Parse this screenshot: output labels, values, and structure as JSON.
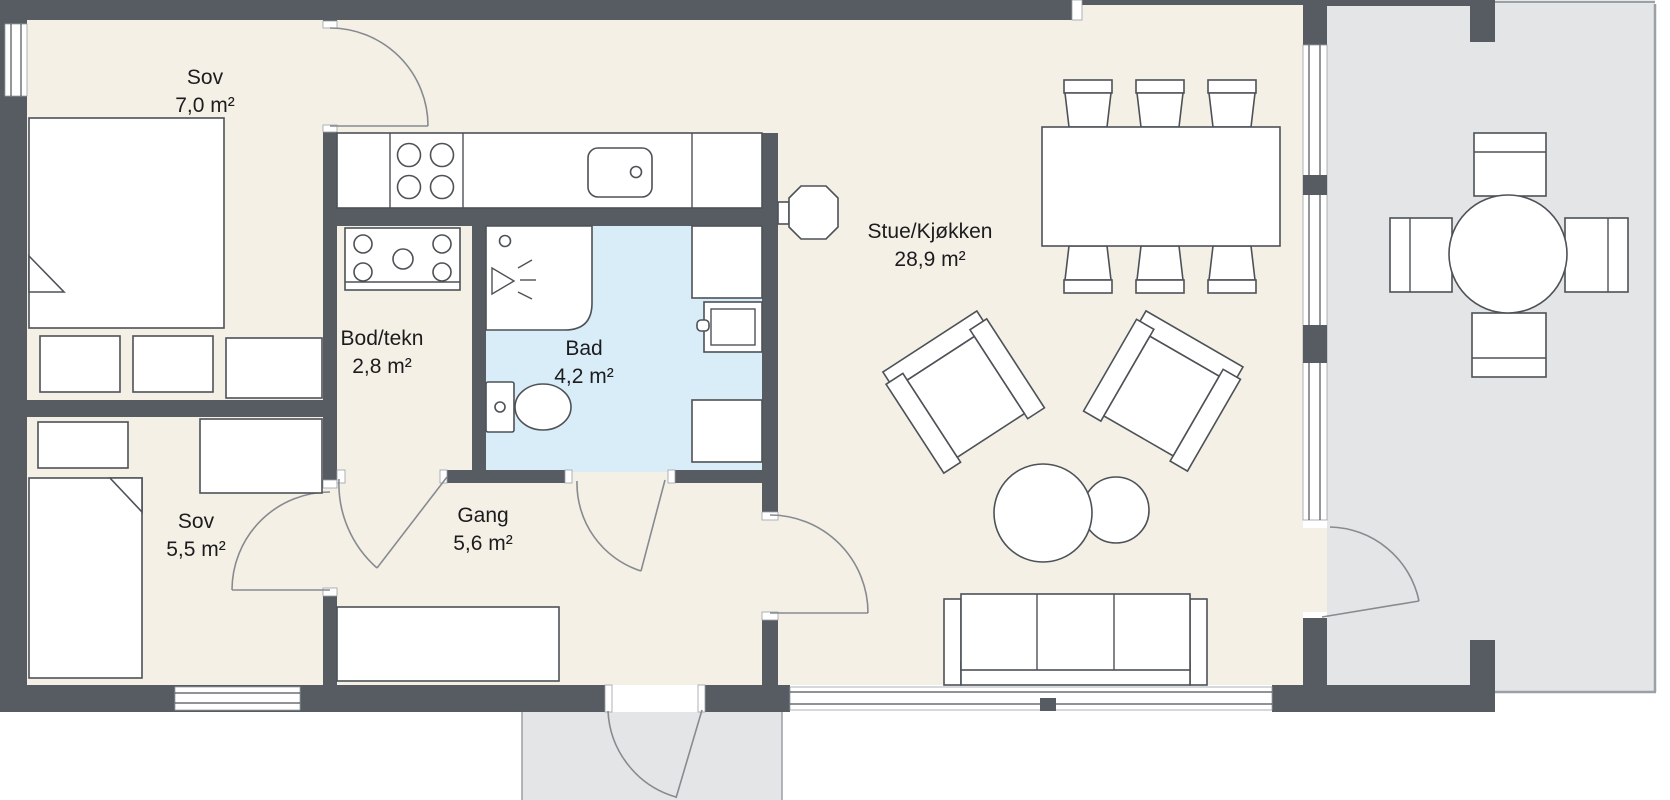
{
  "floorplan": {
    "rooms": [
      {
        "id": "sov-1",
        "name": "Sov",
        "area": "7,0 m²"
      },
      {
        "id": "bod-tekn",
        "name": "Bod/tekn",
        "area": "2,8 m²"
      },
      {
        "id": "bad",
        "name": "Bad",
        "area": "4,2 m²"
      },
      {
        "id": "stue-kjokken",
        "name": "Stue/Kjøkken",
        "area": "28,9 m²"
      },
      {
        "id": "sov-2",
        "name": "Sov",
        "area": "5,5 m²"
      },
      {
        "id": "gang",
        "name": "Gang",
        "area": "5,6 m²"
      }
    ],
    "colors": {
      "wall": "#575c62",
      "floor": "#f4f0e6",
      "bathroom_floor": "#d9edf8",
      "terrace_floor": "#e4e5e7",
      "furniture_outline": "#4d5257",
      "text": "#1c1c1e"
    }
  }
}
